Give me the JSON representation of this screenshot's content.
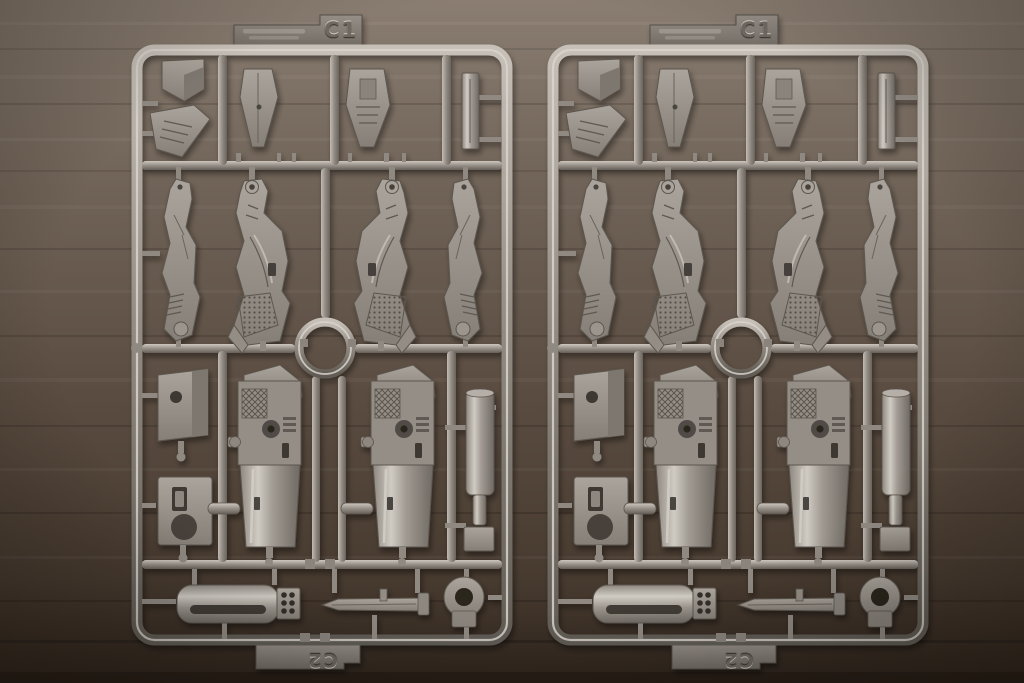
{
  "scene": {
    "description": "Two identical dark-gray plastic model-kit part runners (sprues) photographed side by side on a brown wooden table",
    "surface": "wooden-table"
  },
  "sprues": [
    {
      "id": "sprue-left",
      "top_label": "C1",
      "bottom_label": "C2"
    },
    {
      "id": "sprue-right",
      "top_label": "C1",
      "bottom_label": "C2"
    }
  ],
  "colors": {
    "table_wood": "#64564a",
    "plastic": "#908a83",
    "plastic_highlight": "#d9d4cc",
    "plastic_shadow": "#5f5a54",
    "emboss_text": "#6e6861"
  },
  "parts_catalog": [
    "sensor-bracket",
    "finned-vent",
    "wing-fin",
    "thruster-fin",
    "blade-bar",
    "outer-arm",
    "inner-arm",
    "ring-joint",
    "box-cover",
    "slotted-plate",
    "weapon-receiver",
    "barrel-cylinder",
    "muzzle-cylinder",
    "bayonet-blade",
    "scope-grommet"
  ]
}
